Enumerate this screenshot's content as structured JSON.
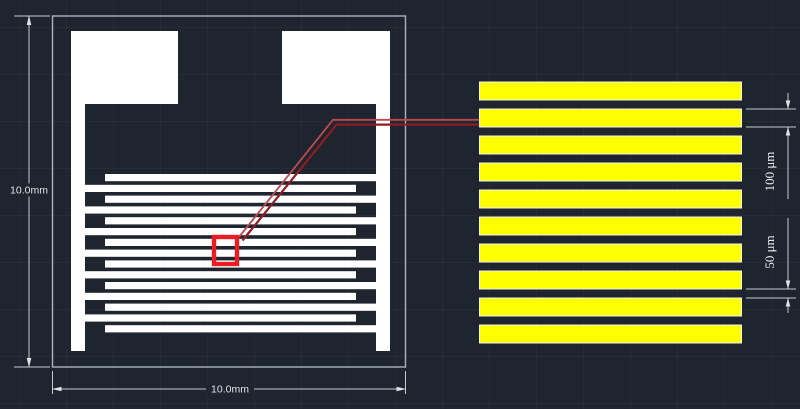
{
  "canvas": {
    "background_color": "#1f252e",
    "grid_color": "rgba(150,168,196,0.05)"
  },
  "device_drawing": {
    "height_dimension_label": "10.0mm",
    "width_dimension_label": "10.0mm",
    "pattern_color": "#ffffff",
    "outline_color": "#aab2bb",
    "highlight_box_color": "#ea1c24",
    "leader_line_colors": [
      "#bb4a50",
      "#8f1d24"
    ],
    "finger_count": 15
  },
  "detail_inset": {
    "stripe_count": 10,
    "stripe_fill_color": "#fdff00",
    "stripe_outline_color": "#ffffff",
    "electrode_width_label": "100 μm",
    "gap_width_label": "50 μm",
    "dimension_color": "#e9ecef"
  }
}
